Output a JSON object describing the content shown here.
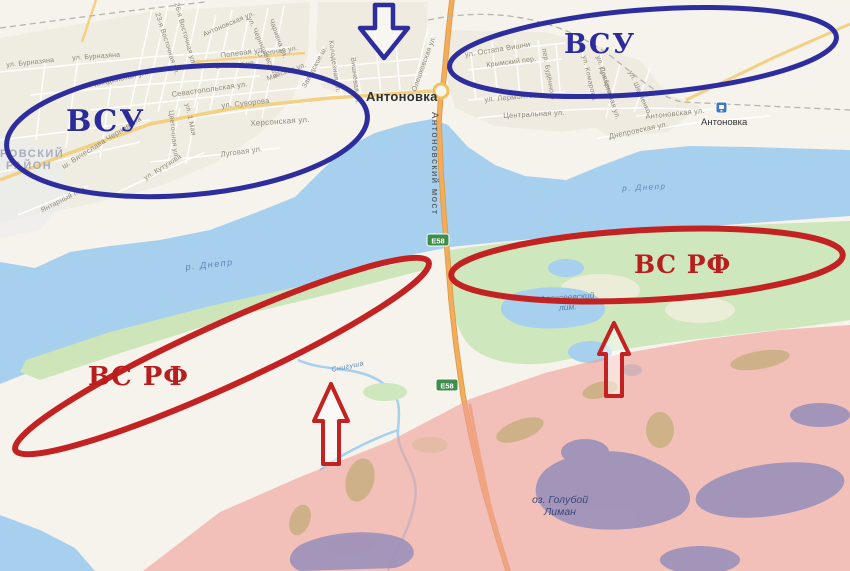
{
  "annotations": {
    "blue_color": "#2d2d9e",
    "red_color": "#c32222",
    "vsu_left": "ВСУ",
    "vsu_right": "ВСУ",
    "vsrf_left": "ВС РФ",
    "vsrf_right": "ВС РФ"
  },
  "map": {
    "town": "Антоновка",
    "station": "Антоновка",
    "bridge": "Антоновский мост",
    "road_badge_1": "E58",
    "road_badge_2": "E58",
    "river_left": "р. Днепр",
    "river_right": "р. Днепр",
    "liman_line1": "Алексеевский",
    "liman_line2": "лим.",
    "lake_line1": "оз. Голубой",
    "lake_line2": "Лиман",
    "stream": "Снигуша",
    "district_line1": "РОВСКИЙ",
    "district_line2": "РАЙОН",
    "streets": [
      "ул. Бурназяна",
      "ул. Бурназяна",
      "23-я Восточная ул.",
      "26-я Восточная ул.",
      "Антоновская ул.",
      "ул. Чернышевского",
      "Чаривна ул.",
      "Полевая ул.",
      "Степная ул.",
      "Степная ул.",
      "Майская ул.",
      "Киндийская ул.",
      "Севастопольская ул.",
      "ул. Суворова",
      "Херсонская ул.",
      "ул. 1 Мая",
      "Цветочная ул.",
      "ш. Вячеслава Черновола",
      "Луговая ул.",
      "ул. Кутузова",
      "Янтарный пер.",
      "Колодезная ул.",
      "Вишнёвая ул.",
      "Олешковская ул.",
      "Заводское ш.",
      "ул. Остапа Вишни",
      "Крымский пер.",
      "ул. Лермонтова",
      "Центральная ул.",
      "пер. Будённого",
      "ул. Комарова",
      "ул. Довженко",
      "Прибрежная ул.",
      "ул. Шевченко",
      "Антоновская ул.",
      "Днепровская ул."
    ]
  }
}
